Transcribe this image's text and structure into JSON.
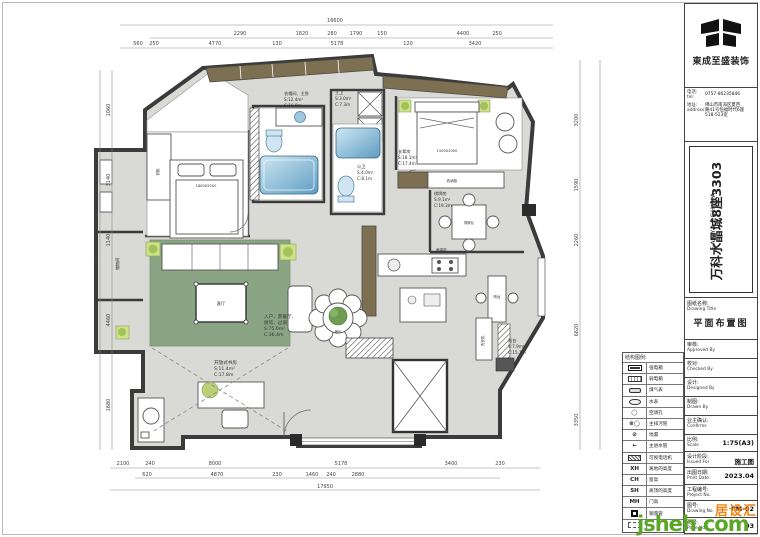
{
  "company": {
    "name": "東成至盛装饰",
    "phone_label": "电话:",
    "phone_label_en": "tel:",
    "phone": "0757-86235846",
    "address_label": "地址:",
    "address_label_en": "address:",
    "address_line1": "佛山市南海区夏西",
    "address_line2": "路41号恒福时代6座",
    "address_line3": "518-523室"
  },
  "project": {
    "name": "万科水晶城8座3303",
    "location": "SANYA, CHINA"
  },
  "titleblock": {
    "drawing_name_label": "图纸名称:",
    "drawing_name_label_en": "Drawing Title",
    "drawing_name": "平面布置图",
    "approvals": [
      {
        "label": "审核:",
        "en": "Approved By"
      },
      {
        "label": "校对:",
        "en": "Checked By"
      },
      {
        "label": "设计:",
        "en": "Designed By"
      },
      {
        "label": "制图:",
        "en": "Drawn By"
      },
      {
        "label": "业主确认:",
        "en": "Confirms"
      }
    ],
    "values": [
      {
        "label": "比例:",
        "en": "Scale",
        "value": "1:75(A3)"
      },
      {
        "label": "设计阶段:",
        "en": "Issued For",
        "value": "施工图"
      },
      {
        "label": "出图日期:",
        "en": "Print Date",
        "value": "2023.04"
      },
      {
        "label": "工程编号:",
        "en": "Project No.",
        "value": ""
      },
      {
        "label": "图号:",
        "en": "Drawing No.",
        "value": "PM-02"
      },
      {
        "label": "页号:",
        "en": "Page No.",
        "value": "03"
      }
    ]
  },
  "legend": {
    "title": "结构图例:",
    "items": [
      {
        "code": "",
        "label": "强电箱"
      },
      {
        "code": "",
        "label": "弱电箱"
      },
      {
        "code": "",
        "label": "煤气表"
      },
      {
        "code": "",
        "label": "水表"
      },
      {
        "code": "◯",
        "label": "空调孔"
      },
      {
        "code": "⊗◯",
        "label": "主排污管"
      },
      {
        "code": "⊘",
        "label": "地漏"
      },
      {
        "code": "←",
        "label": "主进水管"
      },
      {
        "code": "",
        "label": "可视电话机"
      },
      {
        "code": "XH",
        "label": "离地的高度"
      },
      {
        "code": "CH",
        "label": "窗高"
      },
      {
        "code": "SH",
        "label": "离顶的高度"
      },
      {
        "code": "MH",
        "label": "门高"
      },
      {
        "code": "",
        "label": "钢落管"
      },
      {
        "code": "",
        "label": ""
      }
    ]
  },
  "watermark": {
    "brand": "居设汇",
    "site": "jsheh.com",
    "green": "#5aa626",
    "orange": "#f2830e"
  },
  "plan": {
    "rooms": [
      {
        "name": "衣帽间、主卧",
        "area": "S:12.4m²",
        "girth": "C:16.8m"
      },
      {
        "name": "主卫",
        "area": "S:3.0m²",
        "girth": "C:7.3m"
      },
      {
        "name": "公卫",
        "area": "S:4.0m²",
        "girth": "C:8.1m"
      },
      {
        "name": "长辈房",
        "area": "S:18.1m²",
        "girth": "C:17.4m"
      },
      {
        "name": "棋牌房",
        "area": "S:9.1m²",
        "girth": "C:19.3m"
      },
      {
        "name": "入户、客餐厅、",
        "name2": "厨房、过道",
        "area": "S:75.0m²",
        "girth": "C:36.4m"
      },
      {
        "name": "开放式书房",
        "area": "S:11.4m²",
        "girth": "C:17.8m"
      },
      {
        "name": "阳台",
        "area": "S:7.9m²",
        "girth": "C:15.1m"
      }
    ],
    "labels": {
      "living": "客厅",
      "dining": "餐厅",
      "chess_table": "棋牌台",
      "mahjong": "麻将机",
      "bar": "吧台",
      "washer": "洗衣机",
      "sideboard": "收纳柜",
      "wardrobe": "衣柜",
      "storage": "储物间",
      "bed_master": "1800X2000",
      "bed_elder": "1500X2000"
    },
    "dims": {
      "top_total": "16600",
      "top_mid": [
        "2290",
        "1820",
        "280",
        "1790",
        "150",
        "4400",
        "250"
      ],
      "top_inner": [
        "560",
        "250",
        "4770",
        "130",
        "5178",
        "120",
        "3420"
      ],
      "bottom_inner": [
        "2100",
        "240",
        "8000",
        "5178",
        "3400",
        "230"
      ],
      "bottom_mid": [
        "620",
        "4870",
        "230",
        "1460",
        "240",
        "2880"
      ],
      "bottom_total": "17950",
      "left_total": "11480",
      "left": [
        "1060",
        "3140",
        "1140",
        "4460",
        "1680"
      ],
      "right": [
        "3200",
        "1590",
        "2260",
        "6620",
        "3350"
      ]
    }
  }
}
